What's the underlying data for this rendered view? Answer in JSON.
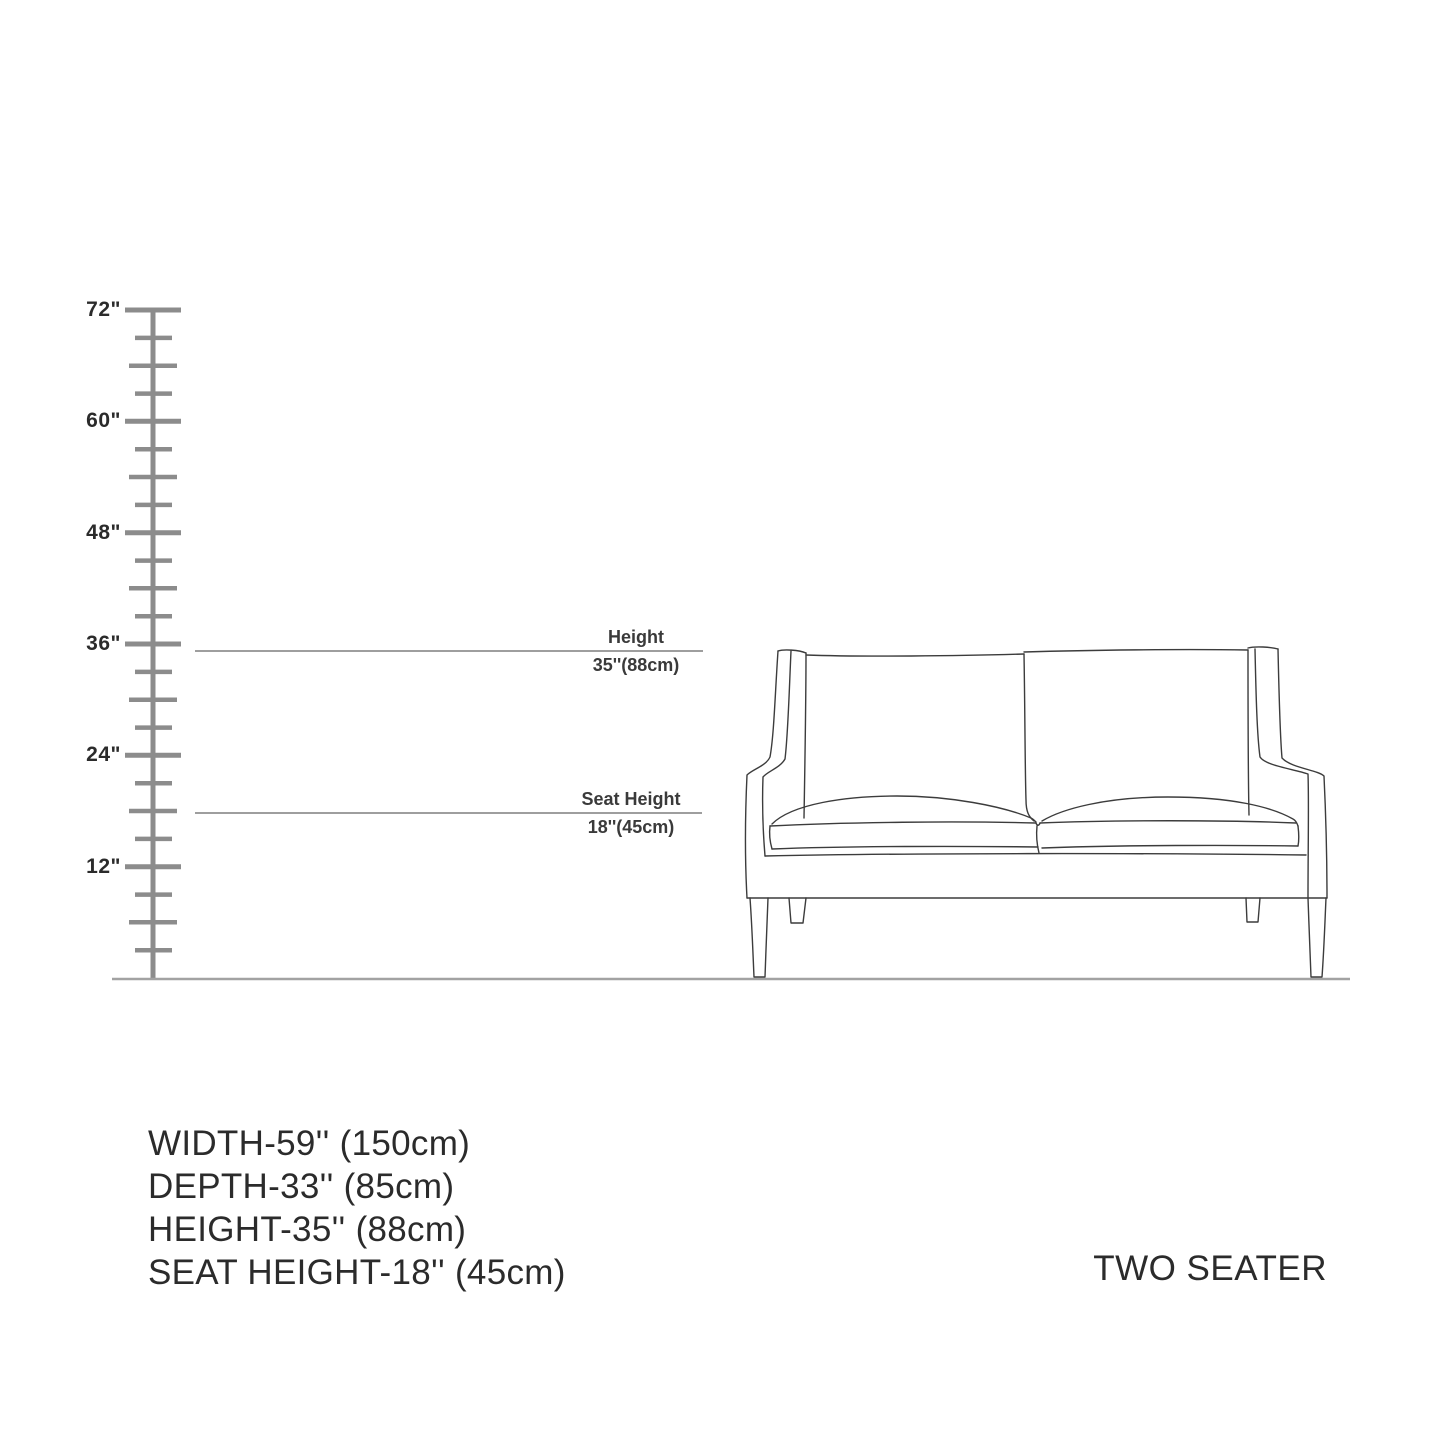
{
  "page": {
    "background": "#ffffff"
  },
  "ruler": {
    "unit_labels": [
      "72\"",
      "60\"",
      "48\"",
      "36\"",
      "24\"",
      "12\""
    ]
  },
  "annotations": {
    "height": {
      "label": "Height",
      "value": "35''(88cm)"
    },
    "seat_height": {
      "label": "Seat Height",
      "value": "18''(45cm)"
    }
  },
  "specs": {
    "width": "WIDTH-59'' (150cm)",
    "depth": "DEPTH-33'' (85cm)",
    "height": "HEIGHT-35'' (88cm)",
    "seat_height": "SEAT HEIGHT-18'' (45cm)"
  },
  "product": {
    "type": "TWO SEATER"
  },
  "colors": {
    "sofa_line": "#3c3c3c",
    "ruler": "#8c8c8c",
    "guide_line": "#9e9e9e",
    "floor_line": "#a2a2a2",
    "text": "#2b2b2b"
  }
}
